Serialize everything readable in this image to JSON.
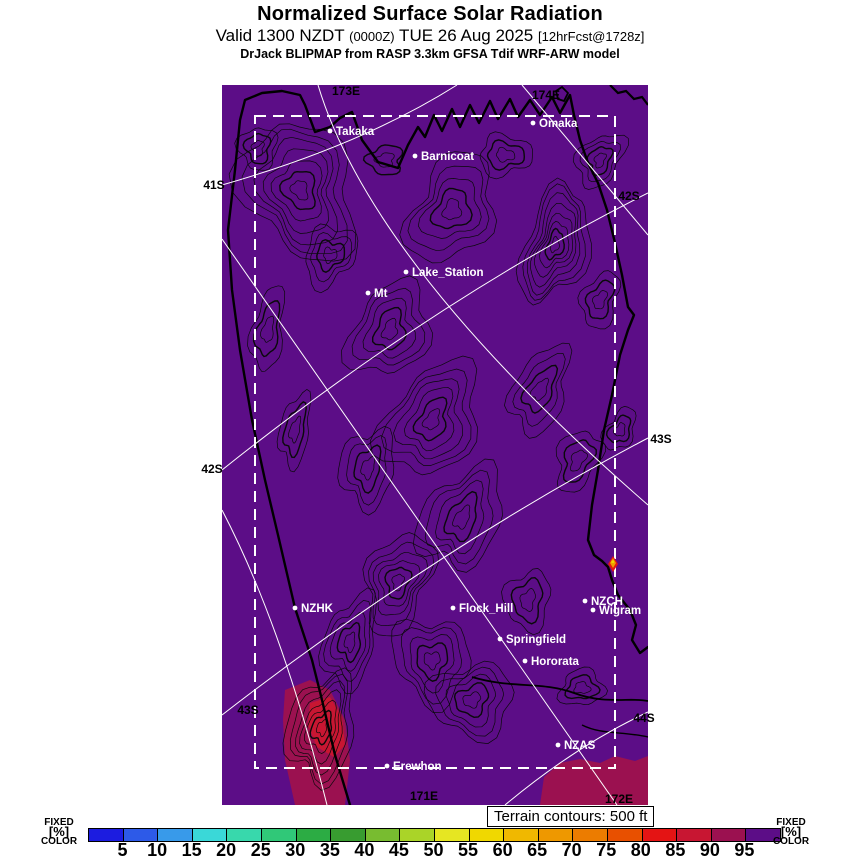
{
  "header": {
    "title": "Normalized Surface Solar Radiation",
    "valid_prefix": "Valid 1300 NZDT ",
    "valid_zulu": "(0000Z)",
    "valid_date": " TUE 26 Aug 2025 ",
    "valid_fcst": "[12hrFcst@1728z]",
    "model_line": "DrJack BLIPMAP from RASP 3.3km GFSA Tdif WRF-ARW model"
  },
  "map": {
    "background_color": "#5c0d87",
    "contour_color": "#0a0a0a",
    "graticule_color": "#ffffff",
    "domain_box_color": "#ffffff",
    "anomaly_colors": {
      "magenta": "#9b1150",
      "crimson": "#c81632",
      "red": "#e41414",
      "orange": "#f0a000",
      "yellow": "#f0d800"
    },
    "stations": [
      {
        "label": "Takaka",
        "x": 330,
        "y": 131
      },
      {
        "label": "Barnicoat",
        "x": 415,
        "y": 156
      },
      {
        "label": "Omaka",
        "x": 533,
        "y": 123
      },
      {
        "label": "Lake_Station",
        "x": 406,
        "y": 272
      },
      {
        "label": "Mt",
        "x": 368,
        "y": 293
      },
      {
        "label": "NZHK",
        "x": 295,
        "y": 608
      },
      {
        "label": "Flock_Hill",
        "x": 453,
        "y": 608
      },
      {
        "label": "NZCH",
        "x": 585,
        "y": 601
      },
      {
        "label": "Wigram",
        "x": 593,
        "y": 610
      },
      {
        "label": "Springfield",
        "x": 500,
        "y": 639
      },
      {
        "label": "Hororata",
        "x": 525,
        "y": 661
      },
      {
        "label": "NZAS",
        "x": 558,
        "y": 745
      },
      {
        "label": "Erewhon",
        "x": 387,
        "y": 766
      }
    ],
    "graticule_labels": [
      {
        "label": "41S",
        "x": 214,
        "y": 185
      },
      {
        "label": "42S",
        "x": 212,
        "y": 469
      },
      {
        "label": "42S",
        "x": 629,
        "y": 196
      },
      {
        "label": "43S",
        "x": 248,
        "y": 710
      },
      {
        "label": "43S",
        "x": 661,
        "y": 439
      },
      {
        "label": "44S",
        "x": 644,
        "y": 718
      },
      {
        "label": "171E",
        "x": 424,
        "y": 796
      },
      {
        "label": "172E",
        "x": 619,
        "y": 799
      },
      {
        "label": "173E",
        "x": 346,
        "y": 91
      },
      {
        "label": "174E",
        "x": 546,
        "y": 95
      }
    ]
  },
  "terrain_note": "Terrain contours: 500 ft",
  "colorbar": {
    "unit": "%",
    "side_label_lines": [
      "FIXED",
      "[%]",
      "COLOR"
    ],
    "ticks": [
      5,
      10,
      15,
      20,
      25,
      30,
      35,
      40,
      45,
      50,
      55,
      60,
      65,
      70,
      75,
      80,
      85,
      90,
      95
    ],
    "colors": [
      "#1c1ce0",
      "#2d5ae8",
      "#389aea",
      "#3ad8d8",
      "#38d8ac",
      "#30c878",
      "#2cac44",
      "#389c30",
      "#78bc30",
      "#aad428",
      "#e6e622",
      "#f0d800",
      "#f0b800",
      "#ee9800",
      "#ec7c00",
      "#e85000",
      "#e41414",
      "#c81632",
      "#9b1150",
      "#5c0d87"
    ]
  }
}
